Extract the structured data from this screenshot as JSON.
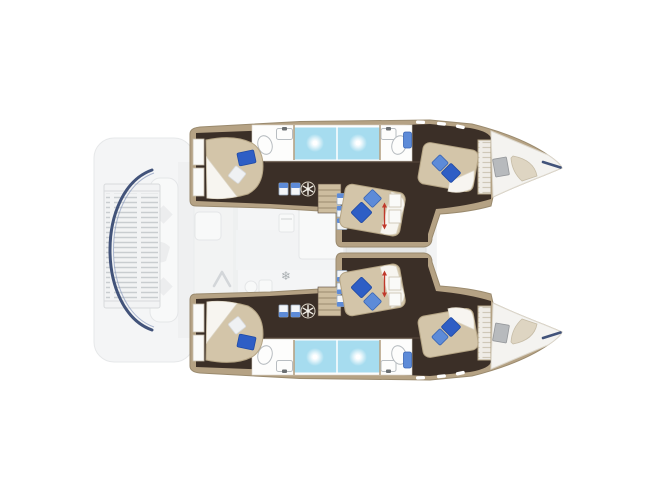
{
  "diagram": {
    "type": "yacht-floorplan",
    "label": "Catamaran interior layout plan, top view, bow to the right, six double berths",
    "hulls": [
      {
        "name": "port (top)",
        "rooms": [
          "aft cabin",
          "aft bathroom",
          "twin shower",
          "forward bathroom",
          "forward cabin",
          "bow cabin"
        ]
      },
      {
        "name": "starboard (bottom)",
        "rooms": [
          "aft cabin",
          "aft bathroom",
          "twin shower",
          "forward bathroom",
          "forward cabin",
          "bow cabin"
        ]
      }
    ],
    "center_areas": [
      "stern platform with grating",
      "cockpit bench",
      "saloon",
      "galley",
      "saloon table",
      "foredeck"
    ],
    "bed_count": 6,
    "icons": [
      "hatch-fan-icon",
      "snowflake-icon",
      "companionway-arrow-icon",
      "bed-dimension-arrow",
      "shower-spray-glow",
      "toilet-icon",
      "sink-icon",
      "hallway-cabinet-icon",
      "oven-icon",
      "bow-tip-accent"
    ]
  },
  "colors": {
    "canvas": "#ffffff",
    "wood_dark": "#3b2f27",
    "wood_mid": "#5a4a3c",
    "wood_trim": "#b5a284",
    "wood_edge": "#9a8a6e",
    "wood_light": "#cdbd9f",
    "bed": "#d3c5a9",
    "bed_shadow": "#b4a484",
    "sheet": "#f7f5f0",
    "sheet_edge": "#ddd6c6",
    "pillow_dark": "#2e5ec5",
    "pillow_dark_edge": "#1f4aa5",
    "pillow_light": "#5d8bd8",
    "pillow_light_edge": "#3a66b5",
    "pillow_white": "#eff1f3",
    "shower": "#a6dcef",
    "fixture_white": "#fdfdfc",
    "fixture_stroke": "#b8bdc1",
    "faucet": "#6b6f72",
    "accent_red": "#c0392b",
    "navy": "#42537a",
    "faded_fill": "#e9ebec",
    "faded_stroke": "#d6d9db",
    "deck_white": "#f4f3f0",
    "deck_edge": "#d9d3c6",
    "window_gray": "#b7babd"
  }
}
